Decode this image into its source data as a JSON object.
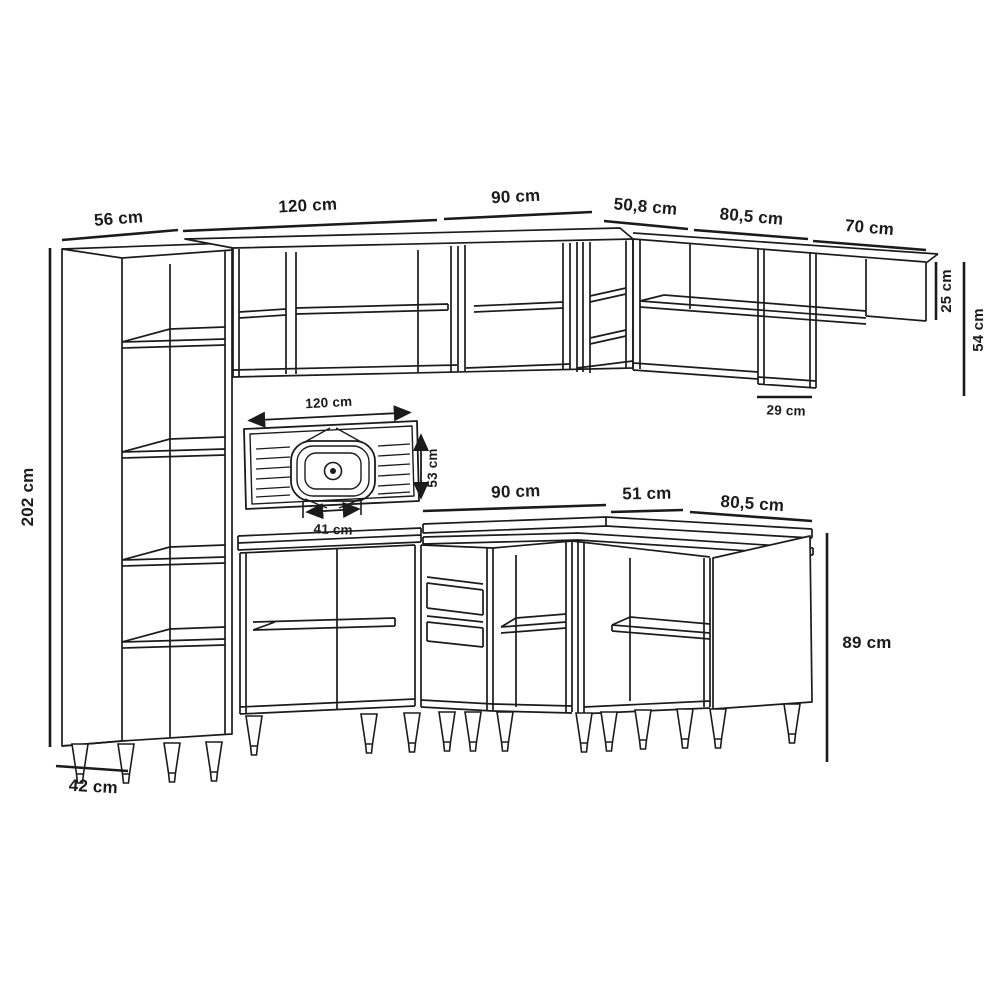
{
  "diagram": {
    "type": "kitchen-cabinet-dimension-drawing",
    "unit": "cm",
    "dims": {
      "tall_width": "56 cm",
      "wall_a_width": "120 cm",
      "wall_b_width": "90 cm",
      "wall_corner_width": "50,8 cm",
      "wall_c_width": "80,5 cm",
      "wall_shelf_width": "70 cm",
      "tall_height": "202 cm",
      "wall_shelf_height": "25 cm",
      "wall_height": "54 cm",
      "wall_depth": "29 cm",
      "sink_top_width": "120 cm",
      "sink_top_depth": "53 cm",
      "sink_bowl_width": "41 cm",
      "base_a_width": "90 cm",
      "base_b_width": "51 cm",
      "base_c_width": "80,5 cm",
      "base_height": "89 cm",
      "tall_depth": "42 cm"
    }
  }
}
